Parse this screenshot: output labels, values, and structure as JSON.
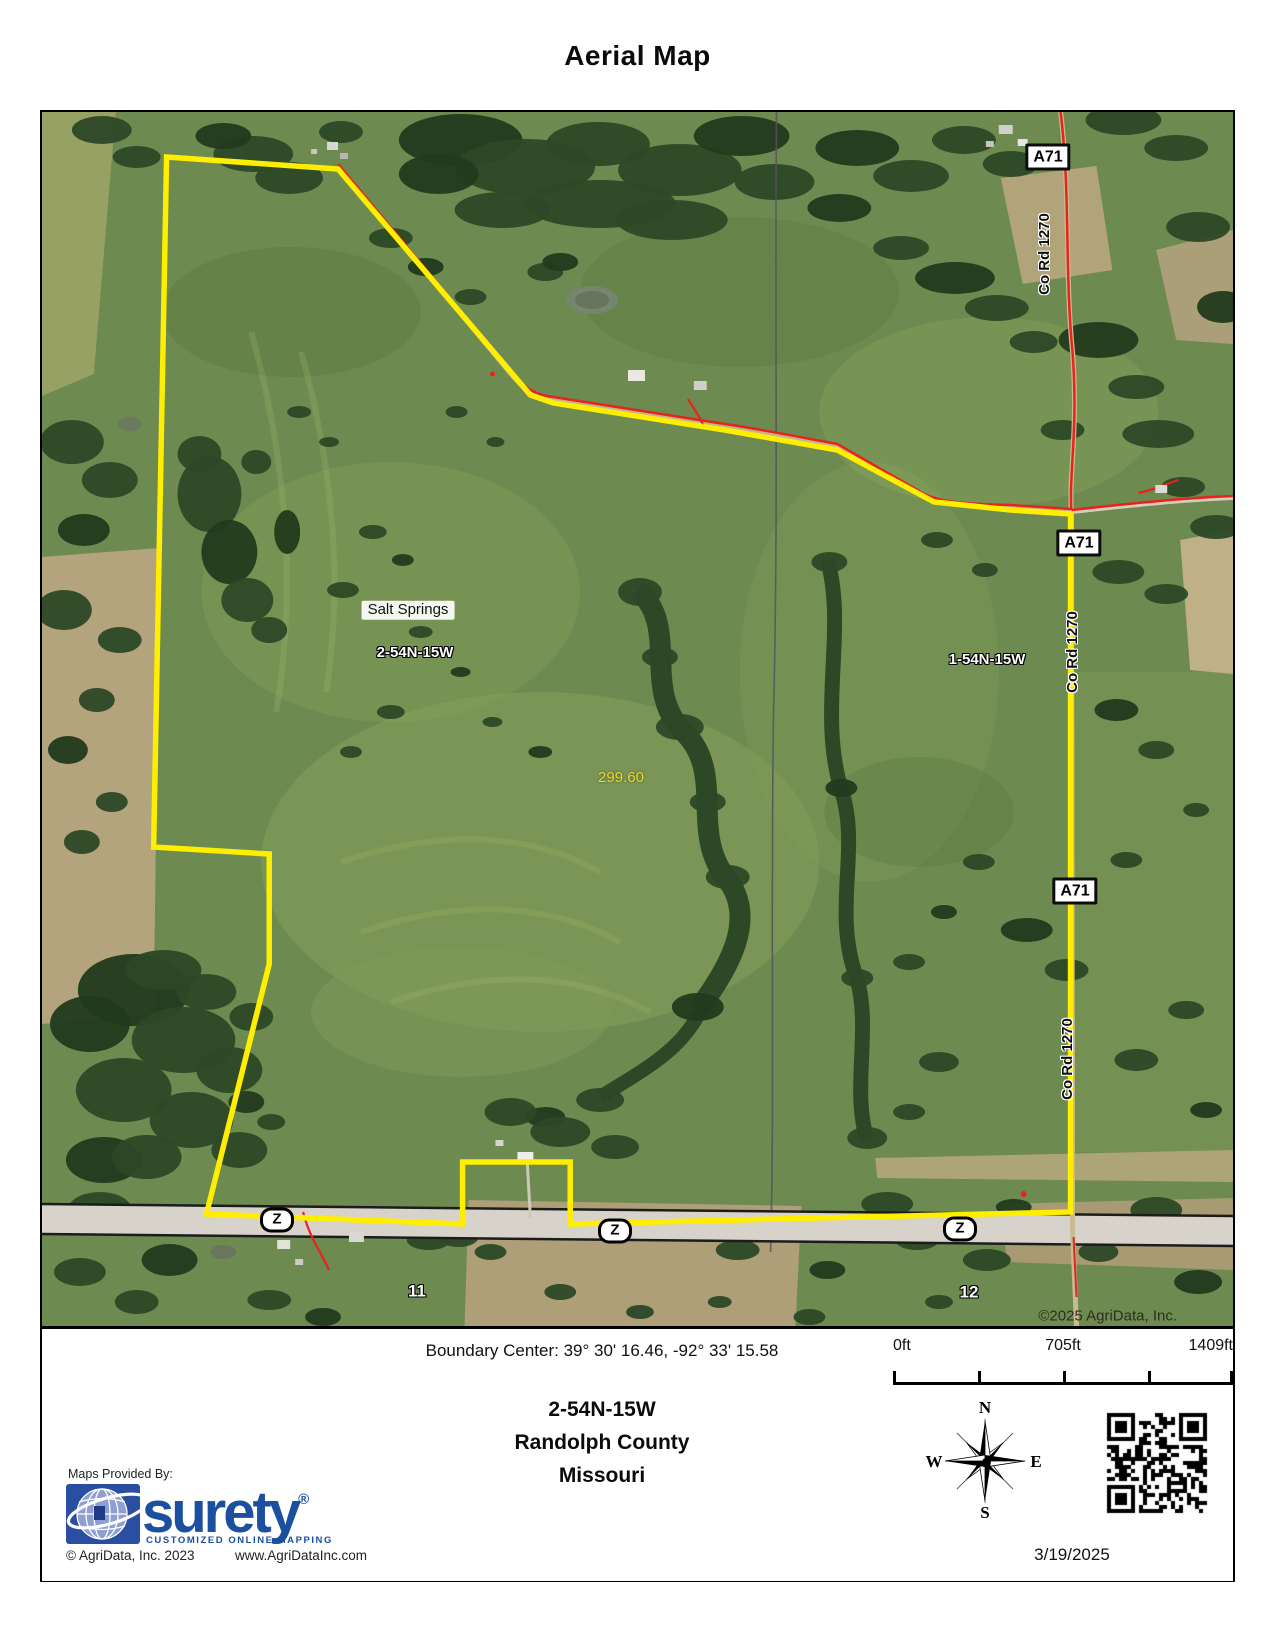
{
  "title": "Aerial Map",
  "map": {
    "place_label": "Salt Springs",
    "section_label_west": "2-54N-15W",
    "section_label_east": "1-54N-15W",
    "acreage_label": "299.60",
    "highway_sign": "A71",
    "road_name_vertical": "Co Rd 1270",
    "route_marker": "Z",
    "section_number_left": "11",
    "section_number_right": "12",
    "copyright": "©2025 AgriData, Inc."
  },
  "footer": {
    "boundary_center_text": "Boundary Center: 39° 30' 16.46,  -92° 33' 15.58",
    "scale": {
      "start": "0ft",
      "middle": "705ft",
      "end": "1409ft"
    },
    "township": "2-54N-15W",
    "county": "Randolph County",
    "state": "Missouri",
    "date": "3/19/2025",
    "compass": {
      "n": "N",
      "e": "E",
      "s": "S",
      "w": "W"
    },
    "provider": {
      "label": "Maps Provided By:",
      "brand": "surety",
      "registered": "®",
      "tagline": "CUSTOMIZED ONLINE MAPPING",
      "copyright": "© AgriData, Inc. 2023",
      "website": "www.AgriDataInc.com"
    }
  },
  "colors": {
    "boundary_yellow": "#ffee00",
    "road_red": "#e8231a",
    "brand_blue": "#1b4fa0",
    "field_green": "#6d8a50"
  }
}
